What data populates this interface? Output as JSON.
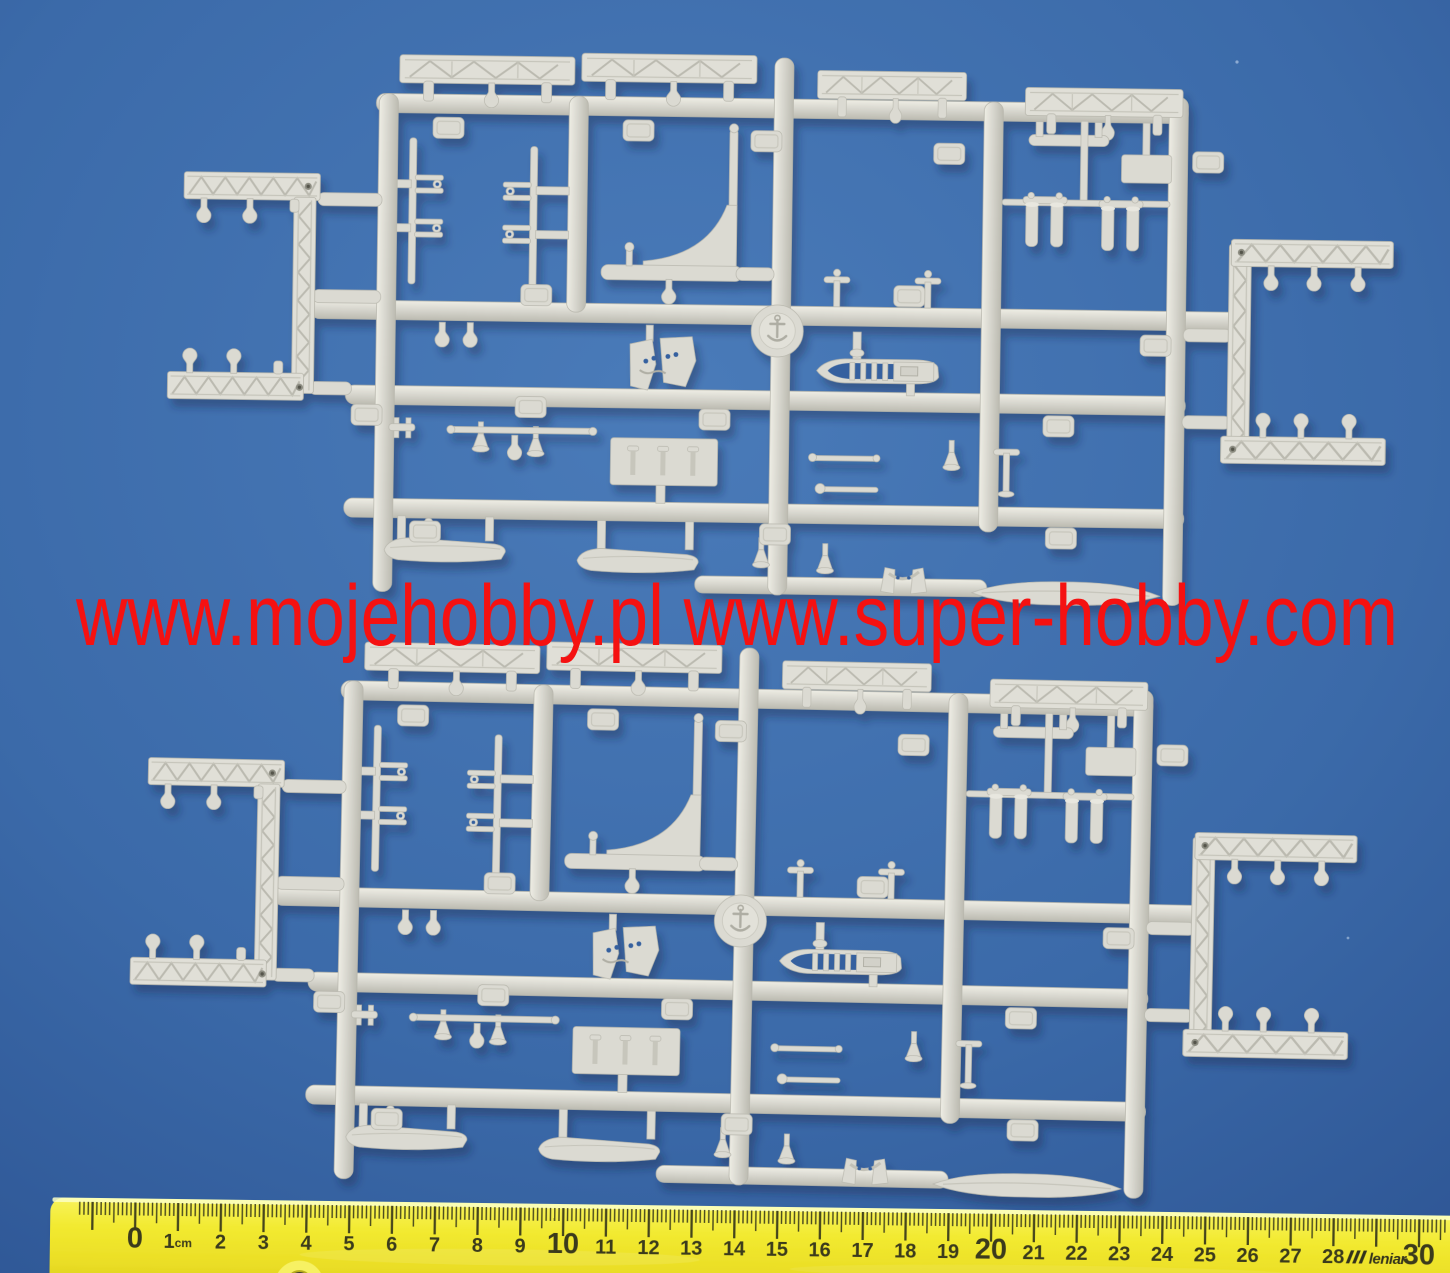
{
  "scene": {
    "subject": "two identical grey plastic model-kit sprues on blue background",
    "background_color": "#3b6aa9",
    "sprue_color": "#dbdad2",
    "sprue_count": 2
  },
  "watermark": {
    "text": "www.mojehobby.pl www.super-hobby.com",
    "color": "#f51111"
  },
  "ruler": {
    "color": "#f2ea30",
    "tick_color": "#45451f",
    "number_color": "#3a3a1d",
    "unit_label": "1cm",
    "brand": "leniar",
    "brand_position_cm": 29,
    "start_cm": 0,
    "end_cm": 30,
    "labels": [
      "0",
      "1cm",
      "2",
      "3",
      "4",
      "5",
      "6",
      "7",
      "8",
      "9",
      "10",
      "11",
      "12",
      "13",
      "14",
      "15",
      "16",
      "17",
      "18",
      "19",
      "20",
      "21",
      "22",
      "23",
      "24",
      "25",
      "26",
      "27",
      "28",
      "",
      "30"
    ]
  }
}
